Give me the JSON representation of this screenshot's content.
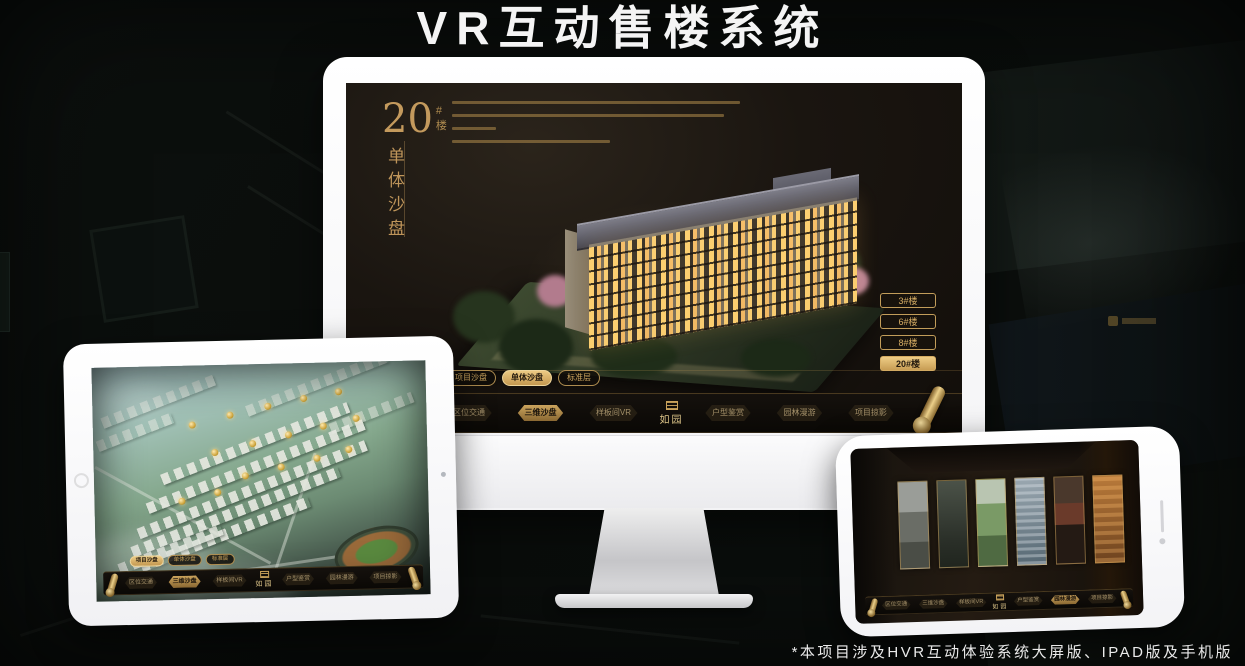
{
  "page": {
    "title": "VR互动售楼系统",
    "footnote": "*本项目涉及HVR互动体验系统大屏版、IPAD版及手机版"
  },
  "brand": {
    "logo_text": "如园",
    "accent_gold": "#c9a05f",
    "accent_gold_bright": "#ecca83",
    "screen_dark": "#16110d"
  },
  "nav": {
    "items": [
      "区位交通",
      "三维沙盘",
      "样板间VR",
      "户型鉴赏",
      "园林漫游",
      "项目掠影"
    ]
  },
  "monitor_app": {
    "hero": {
      "number": "20",
      "suffix": "#楼",
      "title_vertical": "单体沙盘"
    },
    "sub_tabs": [
      {
        "label": "项目沙盘",
        "active": false
      },
      {
        "label": "单体沙盘",
        "active": true
      },
      {
        "label": "标准层",
        "active": false
      }
    ],
    "floor_buttons": [
      {
        "label": "3#楼",
        "active": false
      },
      {
        "label": "6#楼",
        "active": false
      },
      {
        "label": "8#楼",
        "active": false
      },
      {
        "label": "20#楼",
        "active": true
      }
    ],
    "active_nav": "三维沙盘"
  },
  "tablet_app": {
    "sub_tabs": [
      {
        "label": "项目沙盘",
        "active": true
      },
      {
        "label": "单体沙盘",
        "active": false
      },
      {
        "label": "标准层",
        "active": false
      }
    ],
    "active_nav": "三维沙盘"
  },
  "phone_app": {
    "active_nav": "园林漫游"
  }
}
